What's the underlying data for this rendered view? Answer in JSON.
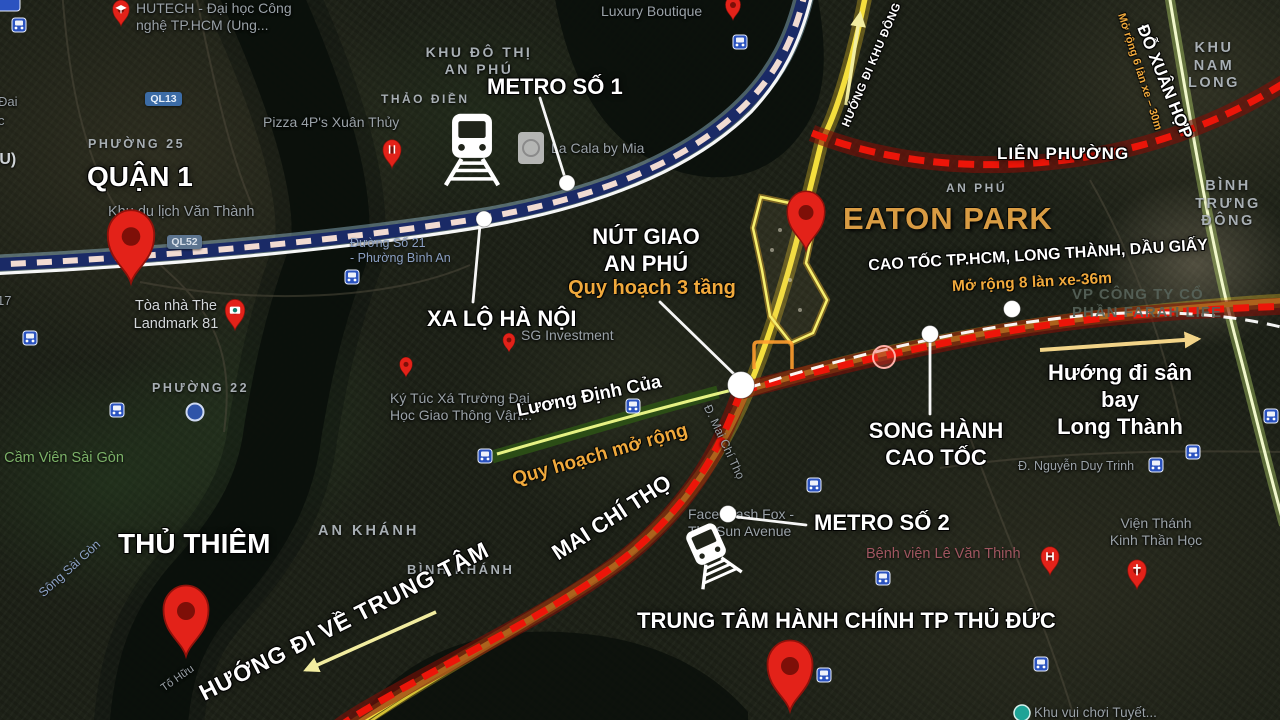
{
  "annotations": {
    "quan1": "QUẬN 1",
    "thu_thiem": "THỦ THIÊM",
    "metro_1": "METRO SỐ 1",
    "metro_2": "METRO SỐ 2",
    "xa_lo_ha_noi": "XA LỘ HÀ NỘI",
    "nut_giao": "NÚT GIAO\nAN PHÚ",
    "nut_giao_note": "Quy hoạch 3 tầng",
    "eaton_park": "EATON PARK",
    "cao_toc": "CAO TỐC TP.HCM, LONG THÀNH, DẦU GIẤY",
    "cao_toc_note": "Mở rộng 8 làn xe-36m",
    "song_hanh": "SONG HÀNH\nCAO TỐC",
    "huong_san_bay": "Hướng đi sân bay\nLong Thành",
    "trung_tam_hanh_chinh": "TRUNG TÂM HÀNH CHÍNH TP THỦ ĐỨC",
    "mai_chi_tho": "MAI CHÍ THỌ",
    "huong_trung_tam": "HƯỚNG ĐI VỀ TRUNG TÂM",
    "huong_khu_dong": "HƯỚNG ĐI KHU ĐÔNG",
    "luong_dinh_cua": "Lương Định Của",
    "quy_hoach_mo_rong": "Quy hoạch mở rộng",
    "lien_phuong": "LIÊN PHƯỜNG",
    "do_xuan_hop": "ĐỖ XUÂN HỢP",
    "do_xuan_hop_note": "Mở rộng 6 làn xe – 30m"
  },
  "places": {
    "hutech": "HUTECH - Đại học Công\nnghệ TP.HCM (Ung...",
    "khu_do_thi_an_phu": "KHU ĐÔ THỊ\nAN PHÚ",
    "thao_dien": "THẢO ĐIỀN",
    "pizza_4ps": "Pizza 4P's Xuân Thủy",
    "la_cala": "La Cala by Mia",
    "luxury_boutique": "Luxury Boutique",
    "phuong_25": "PHƯỜNG 25",
    "phuong_22": "PHƯỜNG 22",
    "ql13": "QL13",
    "ql52": "QL52",
    "khu_du_lich_van_thanh": "Khu du lịch Văn Thành",
    "landmark_81": "Tòa nhà The\nLandmark 81",
    "sg_investment": "SG Investment",
    "ky_tuc_xa": "Ký Túc Xá Trường Đại\nHọc Giao Thông Vận...",
    "cam_vien_sai_gon": "o Cầm Viên Sài Gòn",
    "song_sai_gon": "Sông Sài Gòn",
    "to_huu": "Tố Hữu",
    "an_khanh": "AN KHÁNH",
    "binh_khanh": "BÌNH KHÁNH",
    "an_phu": "AN PHÚ",
    "khu_nam_long": "KHU NAM\nLONG",
    "binh_trung_dong": "BÌNH TRƯNG\nĐÔNG",
    "face_wash_fox": "Face Wash Fox -\nThe Sun Avenue",
    "benh_vien_le_van_thinh": "Bệnh viện Lê Văn Thịnh",
    "vien_thanh_kinh": "Viện Thánh\nKinh Thần Học",
    "nguyen_duy_trinh": "Đ. Nguyễn Duy Trinh",
    "duong_so_21": "Đường Số 21\n- Phường Bình An",
    "vp_cong_ty": "VP CÔNG TY CỔ\nPHẦN FARAH LIFE",
    "d_mai_chi_tho": "Đ. Mai Chí Thọ",
    "khu_vui_choi": "Khu vui chơi Tuyết..."
  },
  "fragments": {
    "f1": "Đai",
    "f2": "c",
    "f3": "(U)",
    "f4": "17"
  },
  "colors": {
    "pin_red": "#e32219",
    "expressway_red": "#ec1509",
    "road_yellow": "#f4de3c",
    "metro_navy": "#1a2a66",
    "metro_glow_blue": "#a9d7ee",
    "highlight_orange": "#f0a93c",
    "eaton_gold": "#d99c43",
    "map_label_gray": "#9aa2a8",
    "arrow_pale_yellow": "#f2eda0",
    "site_boundary_yellow": "#f6ee6e",
    "luong_dinh_cua_green": "#2c4f16",
    "transit_icon_blue": "#2b53c0"
  },
  "icons": {
    "red_map_pin": "location-pin",
    "train_front": "metro-train",
    "bus_stop": "bus",
    "hospital_pin": "H-cross",
    "church_pin": "cross",
    "camera_pin": "camera",
    "restaurant_pin": "fork-knife",
    "university_pin": "graduation-cap",
    "station_dot": "white-dot",
    "direction_arrow": "arrow"
  }
}
